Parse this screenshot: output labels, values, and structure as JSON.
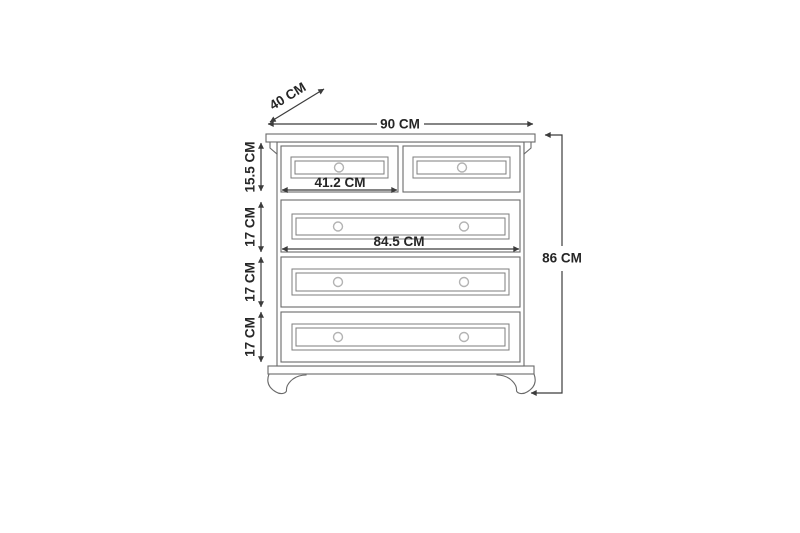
{
  "diagram": {
    "labels": {
      "depth": "40 CM",
      "width": "90 CM",
      "height": "86 CM",
      "top_row_height": "15.5 CM",
      "row2_height": "17 CM",
      "row3_height": "17 CM",
      "row4_height": "17 CM",
      "small_drawer_width": "41.2 CM",
      "wide_drawer_width": "84.5 CM"
    },
    "colors": {
      "background": "#ffffff",
      "furniture_line": "#6a6a6a",
      "panel_line": "#7d7d7d",
      "knob_line": "#b3b3b3",
      "dimension_line": "#3c3c3c",
      "text": "#262626"
    }
  }
}
